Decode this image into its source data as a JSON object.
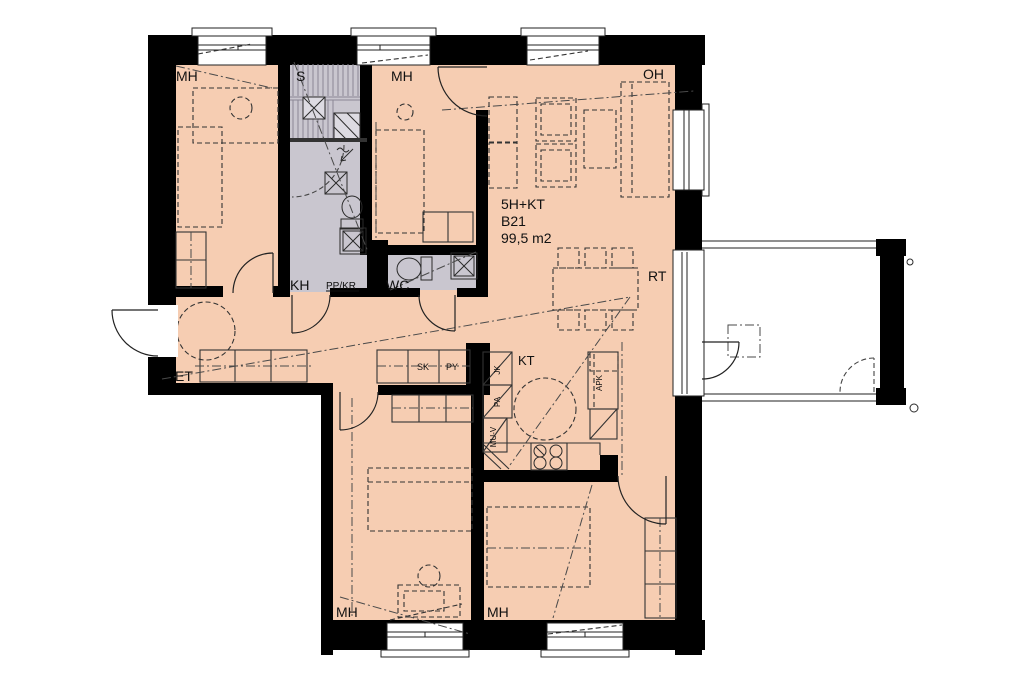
{
  "plan": {
    "apartment": {
      "type": "5H+KT",
      "unit": "B21",
      "area": "99,5 m2"
    },
    "rooms": {
      "bedroom": "MH",
      "sauna": "S",
      "living": "OH",
      "bathroom": "KH",
      "toilet": "WC",
      "hall": "ET",
      "kitchen": "KT",
      "terrace": "RT"
    },
    "fixtures": {
      "washer_dryer": "PP/KR",
      "closet": "SK",
      "drying_cabinet": "PY",
      "fridge": "JK",
      "freezer": "PA",
      "other_reservation": "MU-V",
      "dishwasher": "APK"
    },
    "colors": {
      "floor": "#f6cdb2",
      "wet_room": "#c9c6cf",
      "wall": "#000000",
      "line": "#333333",
      "background": "#ffffff"
    }
  }
}
